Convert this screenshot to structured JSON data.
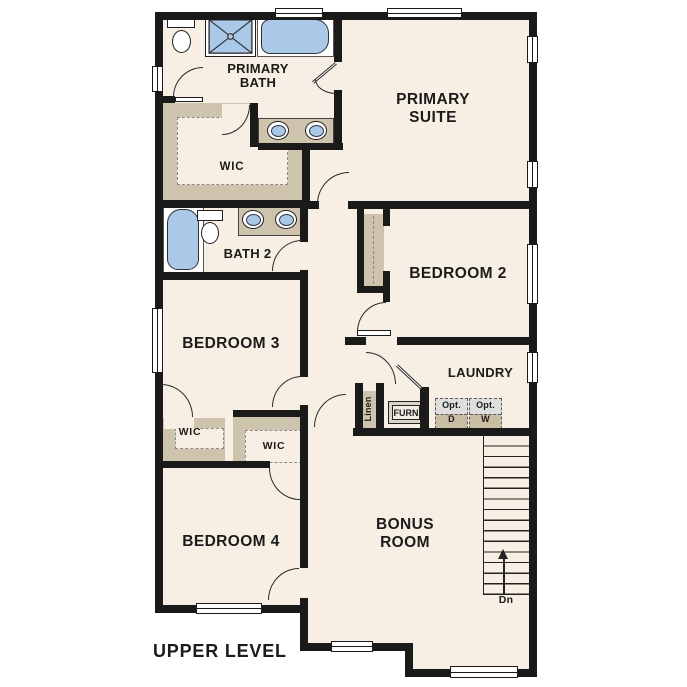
{
  "plan": {
    "level_label": "UPPER LEVEL",
    "rooms": {
      "primary_suite": "PRIMARY SUITE",
      "primary_bath": "PRIMARY BATH",
      "bath2": "BATH 2",
      "bedroom2": "BEDROOM 2",
      "bedroom3": "BEDROOM 3",
      "bedroom4": "BEDROOM 4",
      "laundry": "LAUNDRY",
      "bonus_room": "BONUS ROOM"
    },
    "closets": {
      "primary_wic": "WIC",
      "bedroom3_wic": "WIC",
      "bedroom4_wic": "WIC",
      "linen": "Linen"
    },
    "equipment": {
      "furnace": "FURN",
      "opt_dryer": {
        "prefix": "Opt.",
        "letter": "D"
      },
      "opt_washer": {
        "prefix": "Opt.",
        "letter": "W"
      }
    },
    "stairs": {
      "down_label": "Dn"
    },
    "colors": {
      "floor": "#f7efe3",
      "wall": "#1a1a1a",
      "fixture_blue": "#aac9e8",
      "casework_tan": "#cec3ac",
      "appliance_gray": "#dedede"
    }
  }
}
